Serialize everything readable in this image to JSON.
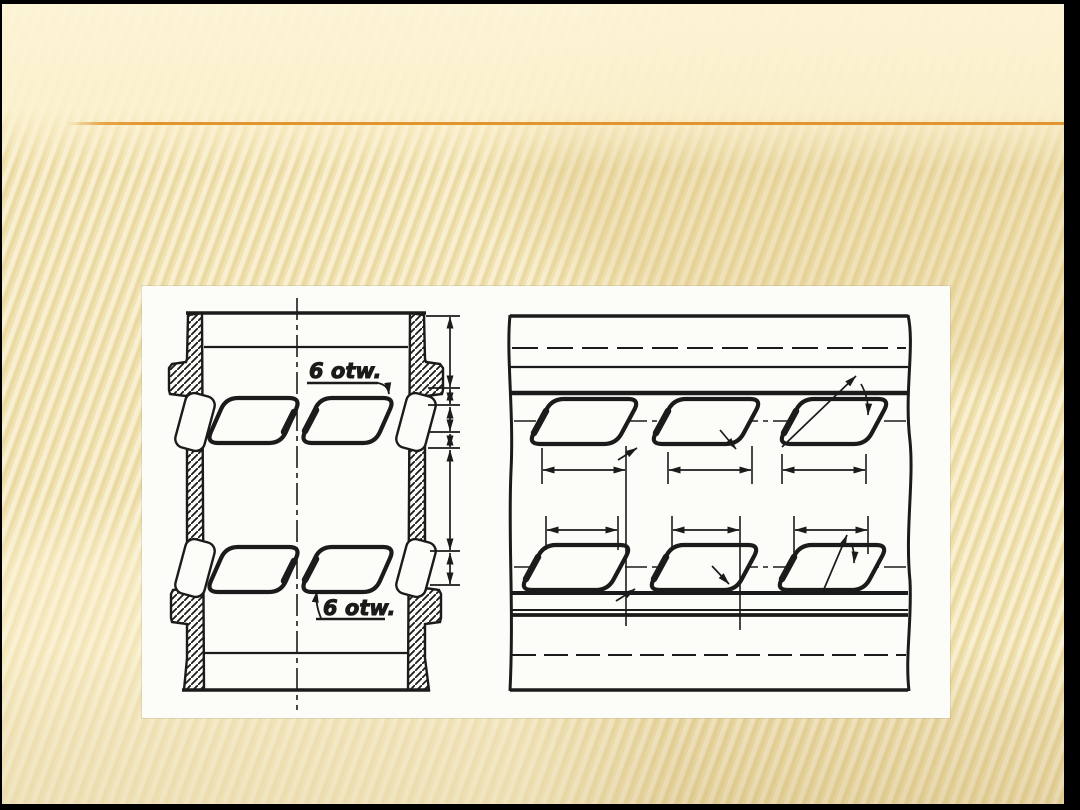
{
  "slide": {
    "frame_color": "#000000",
    "background_base": "#efe0ab",
    "background_top_band": "#f9efc9",
    "stripe_shadow": "#e7d49c",
    "accent_line_color": "#e2952e"
  },
  "figure": {
    "panel_background": "#fcfcf9",
    "ink_color": "#1b1b1b",
    "labels": {
      "port_count_top": "6 otw.",
      "port_count_bottom": "6 otw."
    }
  }
}
